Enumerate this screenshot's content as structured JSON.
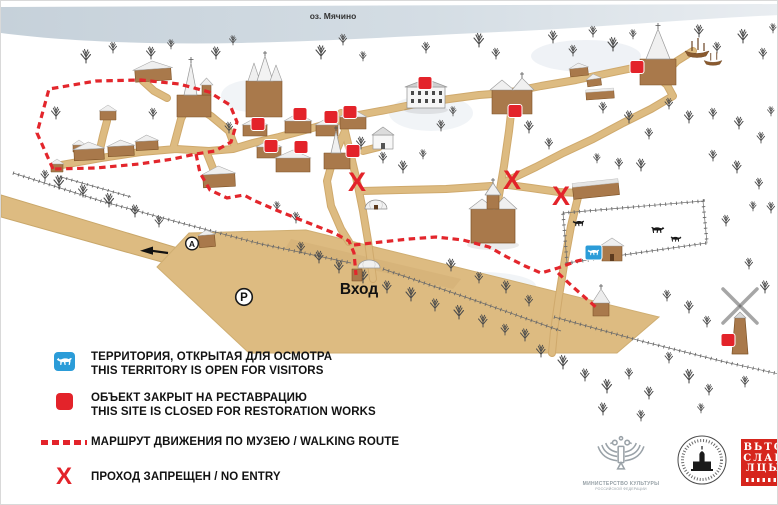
{
  "map": {
    "lake_label": "оз. Мячино",
    "entrance_label": "Вход",
    "bus_stop_label": "А",
    "parking_label": "Р",
    "no_entry_symbol": "X"
  },
  "legend": {
    "open_territory": {
      "line1": "ТЕРРИТОРИЯ, ОТКРЫТАЯ ДЛЯ ОСМОТРА",
      "line2": "THIS TERRITORY IS OPEN FOR VISITORS"
    },
    "closed_site": {
      "line1": "ОБЪЕКТ ЗАКРЫТ НА РЕСТАВРАЦИЮ",
      "line2": "THIS SITE IS CLOSED FOR RESTORATION WORKS"
    },
    "walking_route": {
      "line1": "МАРШРУТ ДВИЖЕНИЯ ПО МУЗЕЮ / WALKING ROUTE"
    },
    "no_entry": {
      "line1": "ПРОХОД ЗАПРЕЩЕН / NO ENTRY"
    }
  },
  "logos": {
    "ministry": {
      "line1": "МИНИСТЕРСТВО КУЛЬТУРЫ",
      "line2": "РОССИЙСКОЙ ФЕДЕРАЦИИ"
    },
    "vitoslavlitsy": {
      "line1": "ВЬТО",
      "line2": "СЛАВ",
      "line3": "ЛЦЫ"
    }
  },
  "colors": {
    "accent_red": "#e3232a",
    "path_tan": "#ddbb81",
    "marker_blue": "#2b9cd8",
    "lake": "#ccd6de"
  }
}
